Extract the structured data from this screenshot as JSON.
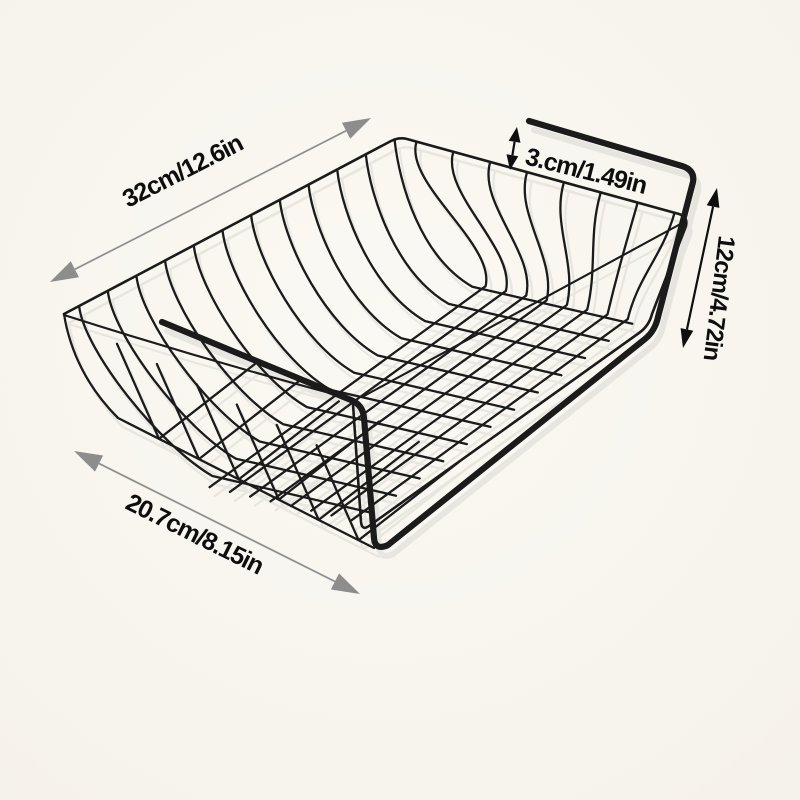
{
  "diagram": {
    "type": "product-dimension-diagram",
    "subject": "black wire under-shelf hanging storage basket",
    "dimensions": [
      {
        "id": "length",
        "label": "32cm/12.6in",
        "arrow_style": "gray",
        "placement": "diagonal-top-left"
      },
      {
        "id": "hook-gap",
        "label": "3.cm/1.49in",
        "arrow_style": "black",
        "placement": "top-right-gap"
      },
      {
        "id": "height",
        "label": "12cm/4.72in",
        "arrow_style": "black",
        "placement": "right-side"
      },
      {
        "id": "depth",
        "label": "20.7cm/8.15in",
        "arrow_style": "gray",
        "placement": "diagonal-bottom-left"
      }
    ]
  },
  "colors": {
    "bg": "#f6f3ec",
    "bg-edge": "#f0ece1",
    "wire": "#1b1b1b",
    "arrow-gray": "#8d8d8d",
    "ink": "#0e0e0e"
  }
}
